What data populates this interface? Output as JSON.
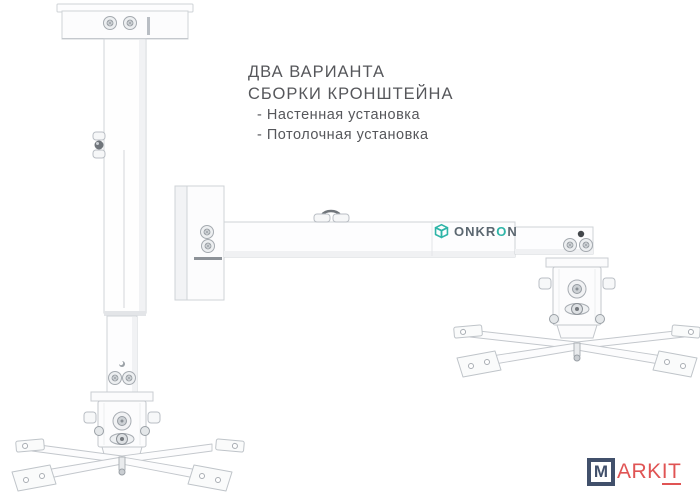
{
  "theme": {
    "background": "#ffffff",
    "text_gray": "#56575b",
    "teal": "#2fb5a8",
    "logo_gray": "#5b6770",
    "red": "#e05454",
    "navy": "#41506b"
  },
  "info_text": {
    "heading_line1": "ДВА ВАРИАНТА",
    "heading_line2": "СБОРКИ КРОНШТЕЙНА",
    "bullet1": "- Настенная установка",
    "bullet2": "- Потолочная установка"
  },
  "brand": {
    "name": "ONKRON",
    "logo_prefix": "ONKR",
    "logo_accent_letter": "O",
    "logo_suffix": "N"
  },
  "watermark": {
    "letter_boxed": "M",
    "text_mid": "ARK",
    "text_underlined": "IT"
  },
  "illustrations": {
    "ceiling_mount": "projector-ceiling-mount-bracket",
    "wall_mount": "projector-wall-mount-bracket"
  }
}
